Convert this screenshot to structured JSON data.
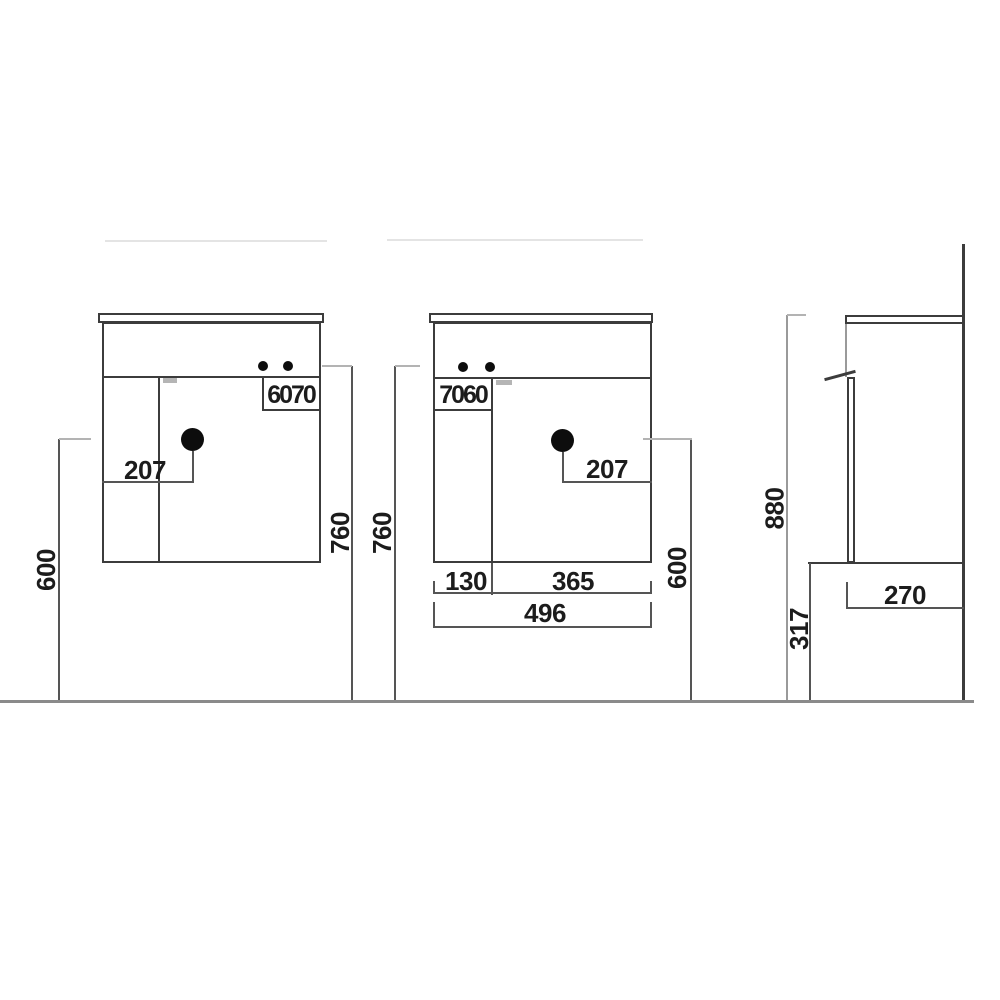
{
  "diagram": {
    "type": "technical-dimension-drawing",
    "subject": "wall-hung vanity cabinet, three orthographic views",
    "colors": {
      "ink": "#3c3c3c",
      "dimension_line": "#555555",
      "ground_line": "#8a8a8a",
      "background": "#ffffff"
    },
    "left_view": {
      "faucet_hole_offsets": "6070",
      "sink_center_from_left": "207",
      "height_to_sink_center": "600",
      "worktop_height": "760"
    },
    "front_view": {
      "faucet_hole_offsets": "7060",
      "sink_center_from_right": "207",
      "door_width": "130",
      "basin_section_width": "365",
      "total_width": "496",
      "height_to_sink_center": "600",
      "worktop_height": "760"
    },
    "side_view": {
      "overall_height": "880",
      "clearance_below": "317",
      "depth": "270"
    }
  }
}
